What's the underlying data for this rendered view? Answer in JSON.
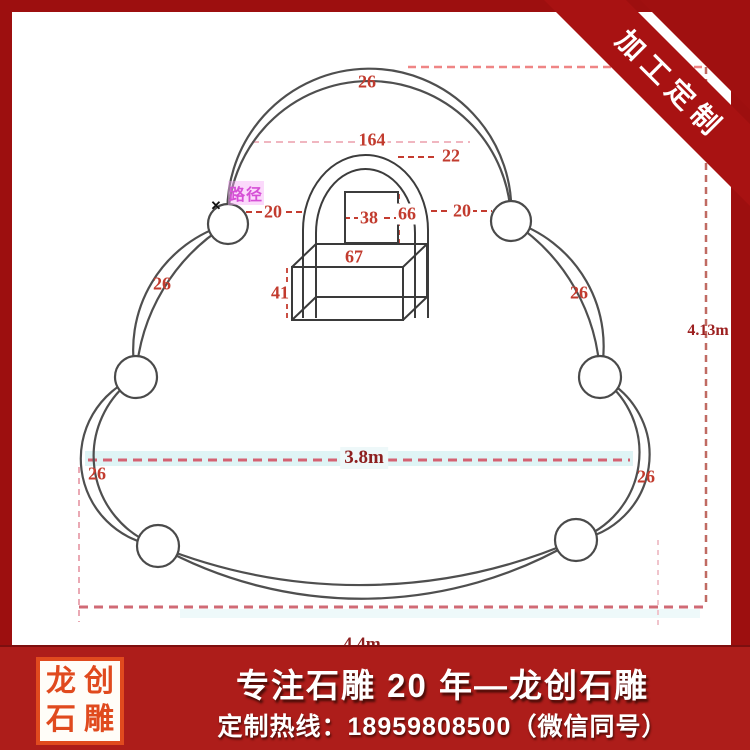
{
  "ribbon": {
    "label": "加工定制"
  },
  "banner": {
    "line1": "专注石雕 20 年—龙创石雕",
    "line2": "定制热线：18959808500（微信同号）",
    "seal_chars": [
      "龙",
      "创",
      "石",
      "雕"
    ]
  },
  "diagram": {
    "path_label": "路径",
    "x_mark": "✕",
    "dims": {
      "top_arc": "26",
      "left_upper": "26",
      "right_upper": "26",
      "bottom_left": "26",
      "bottom_right": "26",
      "opening_width": "164",
      "band": "22",
      "gap_left": "20",
      "gap_right": "20",
      "square_width": "38",
      "square_height": "66",
      "box_width": "67",
      "box_height": "41",
      "total_width": "3.8m",
      "total_height": "4.13m",
      "bottom_width_partial": "4.4m"
    },
    "colors": {
      "line": "#4f4f4f",
      "dimension_text": "#c23b2e",
      "dash_pink": "#e98b95",
      "highlight_cyan": "#dff4f5",
      "path_magenta": "#d64fd6"
    }
  },
  "frame": {
    "border_color": "#9d0f0f",
    "banner_color": "#ad1d1a"
  }
}
